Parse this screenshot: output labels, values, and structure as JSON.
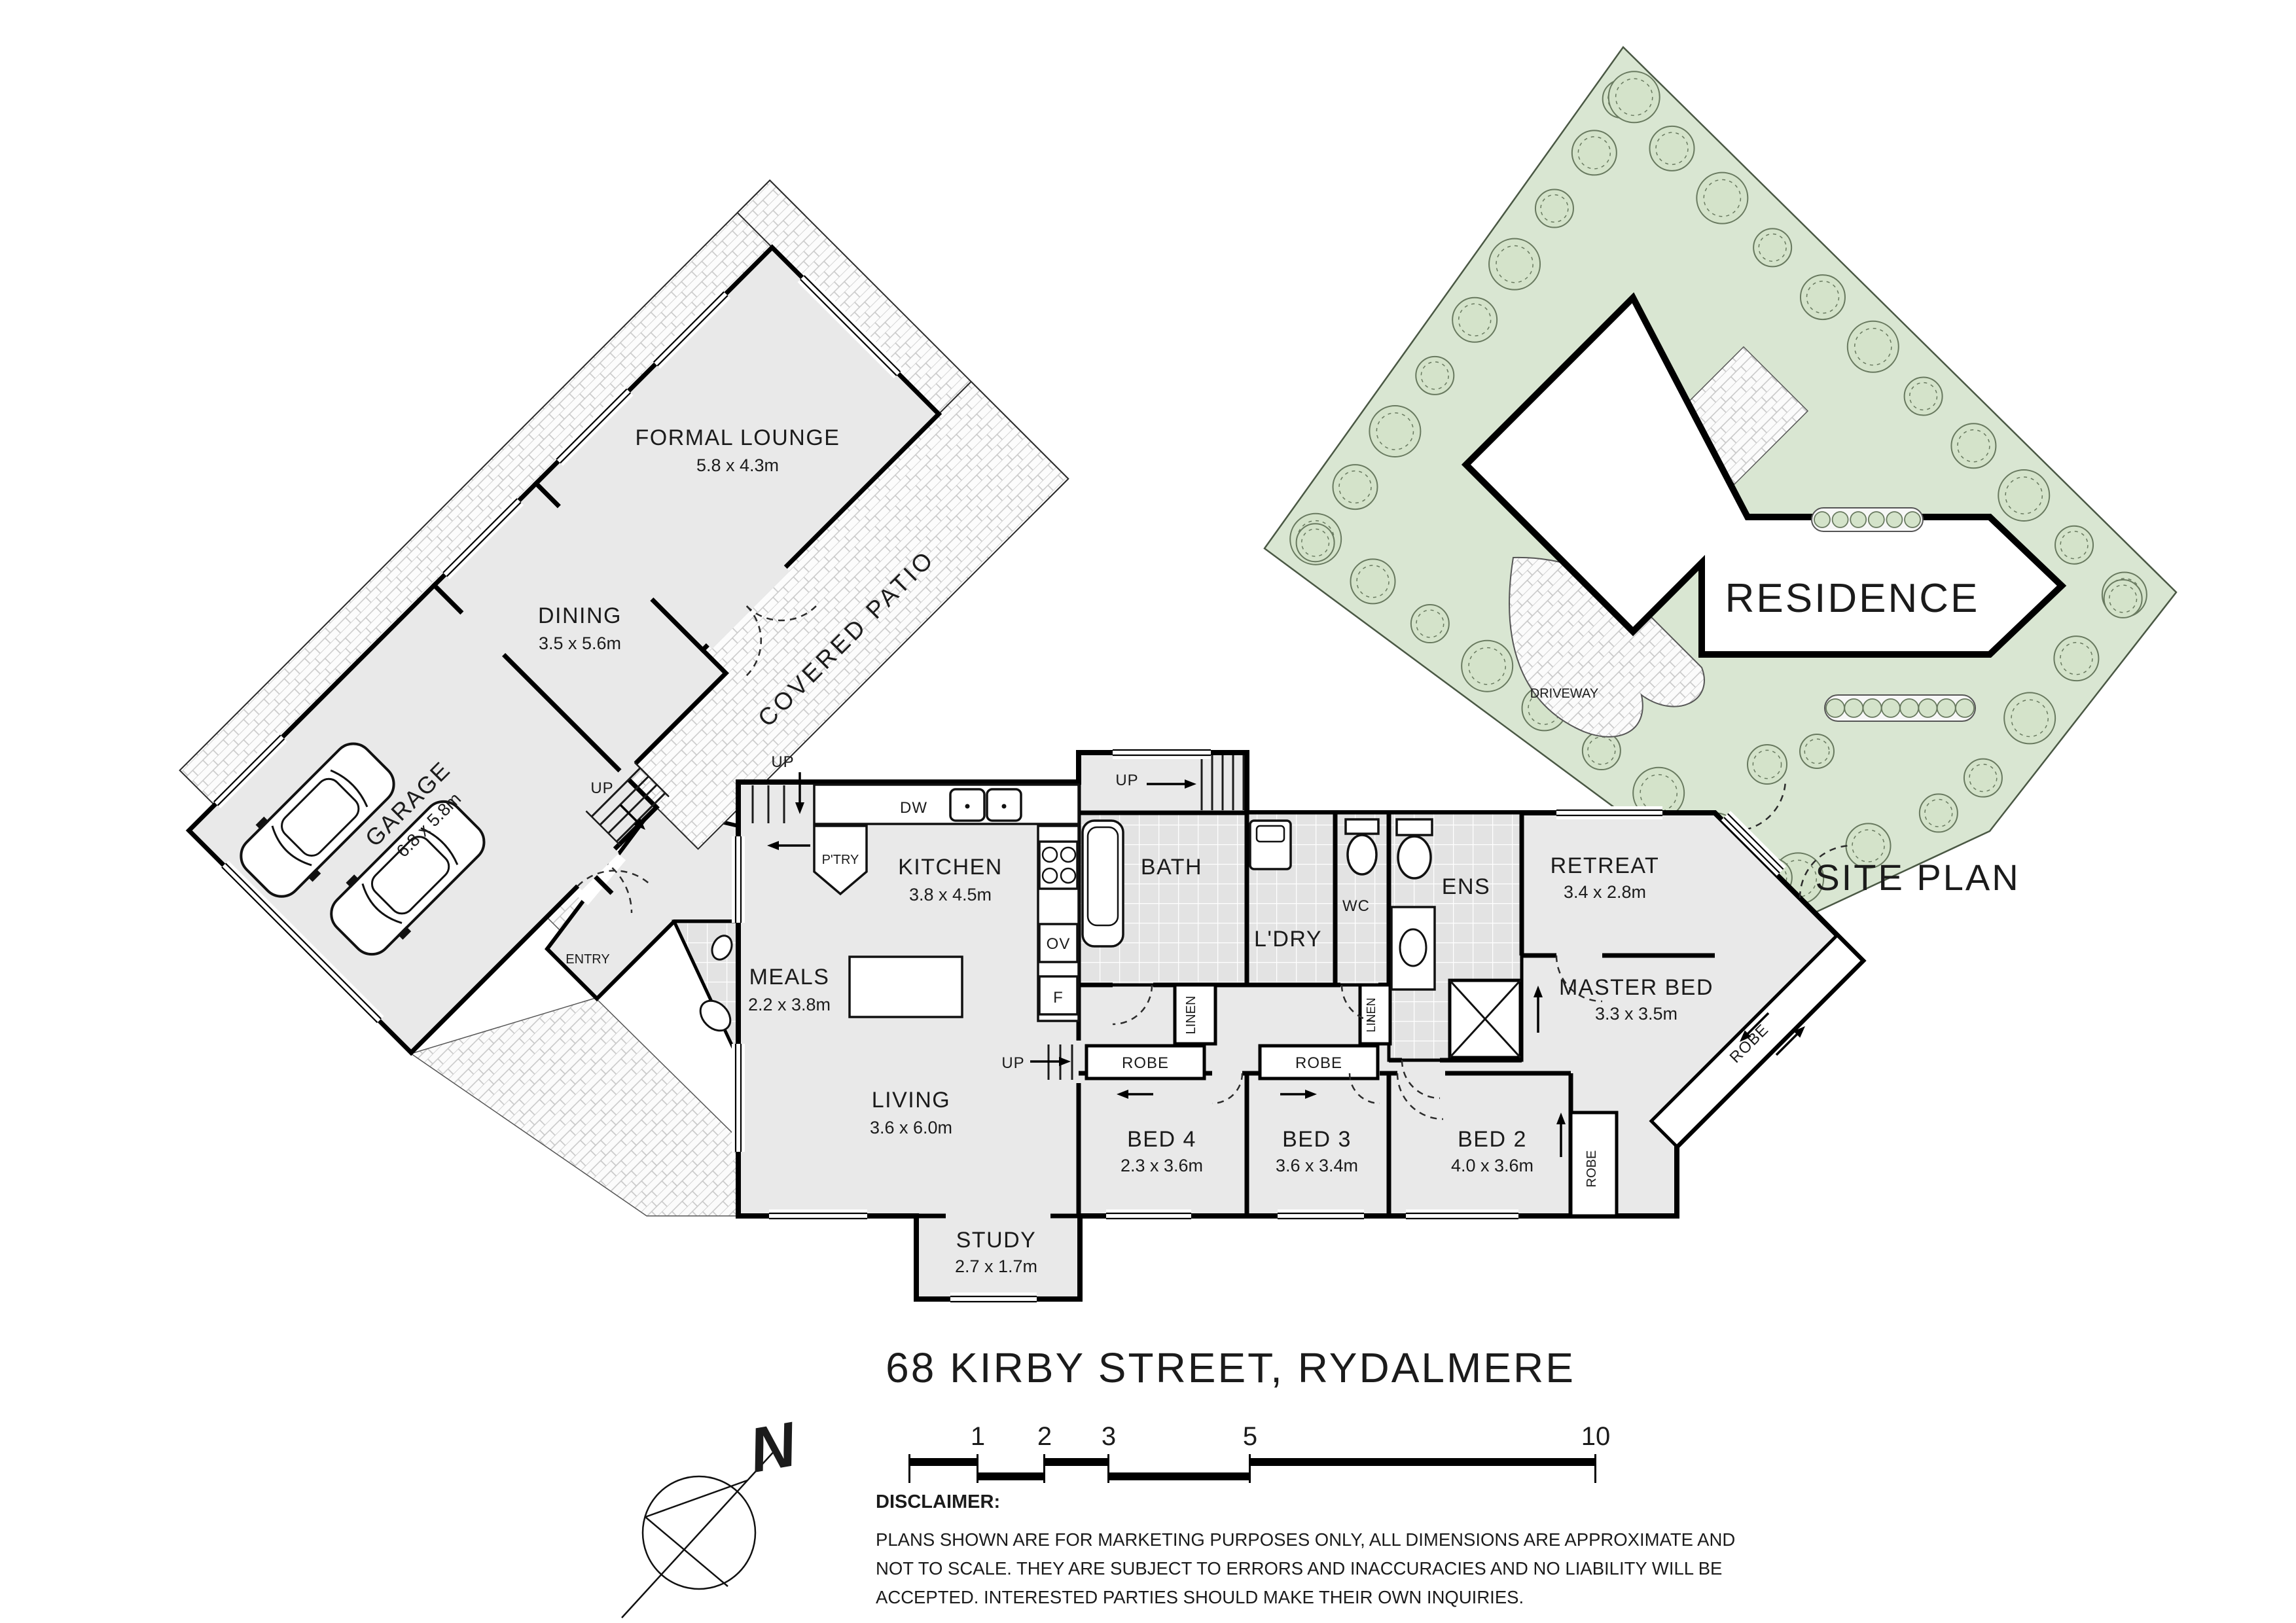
{
  "title": "68 KIRBY STREET, RYDALMERE",
  "floor_plan": {
    "rooms": {
      "formal_lounge": {
        "name": "FORMAL LOUNGE",
        "dims": "5.8 x 4.3m"
      },
      "dining": {
        "name": "DINING",
        "dims": "3.5 x 5.6m"
      },
      "garage": {
        "name": "GARAGE",
        "dims": "6.8 x 5.8m"
      },
      "kitchen": {
        "name": "KITCHEN",
        "dims": "3.8 x 4.5m"
      },
      "meals": {
        "name": "MEALS",
        "dims": "2.2 x 3.8m"
      },
      "living": {
        "name": "LIVING",
        "dims": "3.6 x 6.0m"
      },
      "study": {
        "name": "STUDY",
        "dims": "2.7 x 1.7m"
      },
      "bath": {
        "name": "BATH"
      },
      "laundry": {
        "name": "L'DRY"
      },
      "wc": {
        "name": "WC"
      },
      "ensuite": {
        "name": "ENS"
      },
      "retreat": {
        "name": "RETREAT",
        "dims": "3.4 x 2.8m"
      },
      "master_bed": {
        "name": "MASTER BED",
        "dims": "3.3 x 3.5m"
      },
      "bed2": {
        "name": "BED 2",
        "dims": "4.0 x 3.6m"
      },
      "bed3": {
        "name": "BED 3",
        "dims": "3.6 x 3.4m"
      },
      "bed4": {
        "name": "BED 4",
        "dims": "2.3 x 3.6m"
      }
    },
    "labels": {
      "covered_patio": "COVERED PATIO",
      "entry": "ENTRY",
      "up": "UP",
      "pantry": "P'TRY",
      "dishwasher": "DW",
      "oven": "OV",
      "fridge": "F",
      "linen": "LINEN",
      "robe": "ROBE"
    }
  },
  "site_plan": {
    "residence_label": "RESIDENCE",
    "driveway_label": "DRIVEWAY",
    "caption": "SITE PLAN"
  },
  "north_indicator": {
    "label": "N"
  },
  "scale_bar": {
    "tick_labels": [
      "1",
      "2",
      "3",
      "5",
      "10"
    ]
  },
  "disclaimer": {
    "heading": "DISCLAIMER:",
    "lines": [
      "PLANS SHOWN ARE FOR MARKETING PURPOSES ONLY, ALL DIMENSIONS ARE APPROXIMATE AND",
      "NOT TO SCALE. THEY ARE SUBJECT TO ERRORS AND INACCURACIES AND NO LIABILITY WILL BE",
      "ACCEPTED. INTERESTED PARTIES SHOULD MAKE THEIR OWN INQUIRIES."
    ]
  },
  "colors": {
    "wall": "#000000",
    "room_fill": "#e9e9e9",
    "tile_fill": "#e3e3e3",
    "site_green": "#d9e6d2",
    "tree_stroke": "#68795f",
    "text": "#1b1b1b"
  }
}
